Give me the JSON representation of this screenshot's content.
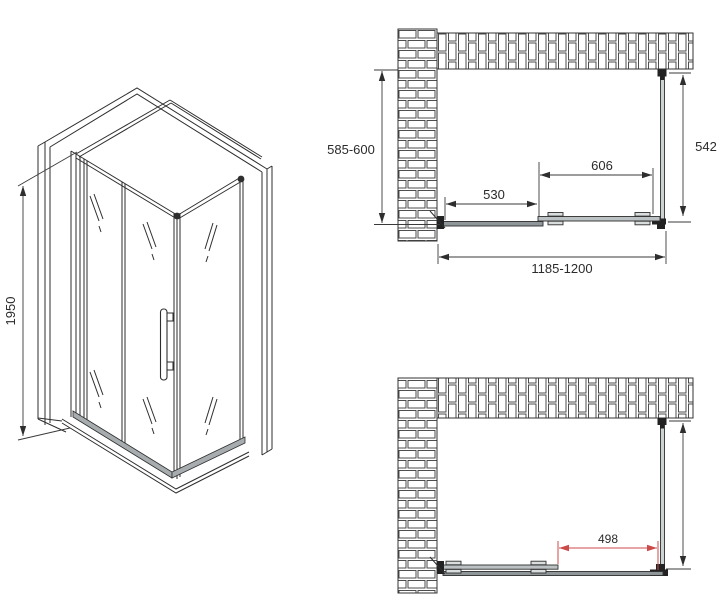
{
  "drawing": {
    "background_color": "#ffffff",
    "line_color": "#2e2e2e",
    "red_accent_color": "#cc4a4a",
    "views": {
      "isometric": {
        "dims": {
          "height": "1950"
        }
      },
      "plan_closed": {
        "dims": {
          "depth_range": "585-600",
          "side_panel": "542",
          "fixed_segment": "530",
          "door_segment": "606",
          "width_range": "1185-1200"
        }
      },
      "plan_open": {
        "dims": {
          "door_opening": "498"
        }
      }
    }
  }
}
